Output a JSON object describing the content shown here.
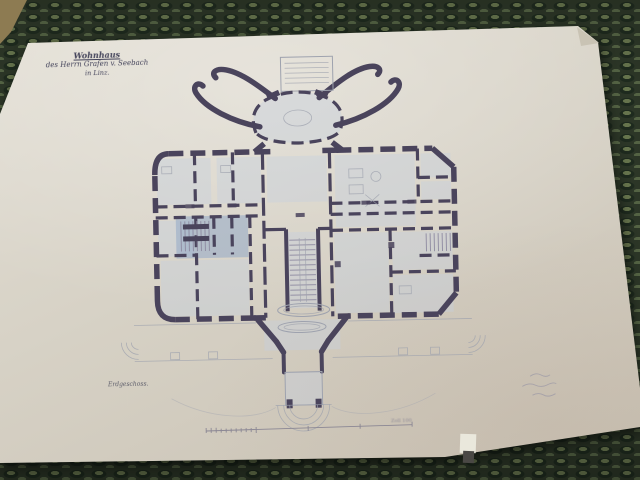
{
  "title_block": {
    "line1": "Wohnhaus",
    "line2": "des Herrn Grafen v. Seebach",
    "line3": "in Linz."
  },
  "labels": {
    "floor": "Erdgeschoss.",
    "scale_note": "Zoll 100"
  },
  "colors": {
    "carpet_base": "#2c3627",
    "carpet_blob": "#66744d",
    "carpet_blob2": "#546344",
    "carpet_shadow": "#1e2a1e",
    "paper": "#d7d2c6",
    "paper_light": "#e4e0d6",
    "paper_dark": "#c8c0b2",
    "dogear": "#c9c3b4",
    "ink": "#4a445c",
    "faint": "#9ea2ae",
    "tread": "#8d89a0",
    "wash": "#c6cfdd",
    "wash_blue": "#8ca3c6",
    "pencil": "#a39fa8",
    "title_ink": "#43435a",
    "book": "#8d7b52",
    "book_dark": "#5f5338",
    "tab_white": "#eae8dc",
    "tab_dark": "#4a4845"
  }
}
